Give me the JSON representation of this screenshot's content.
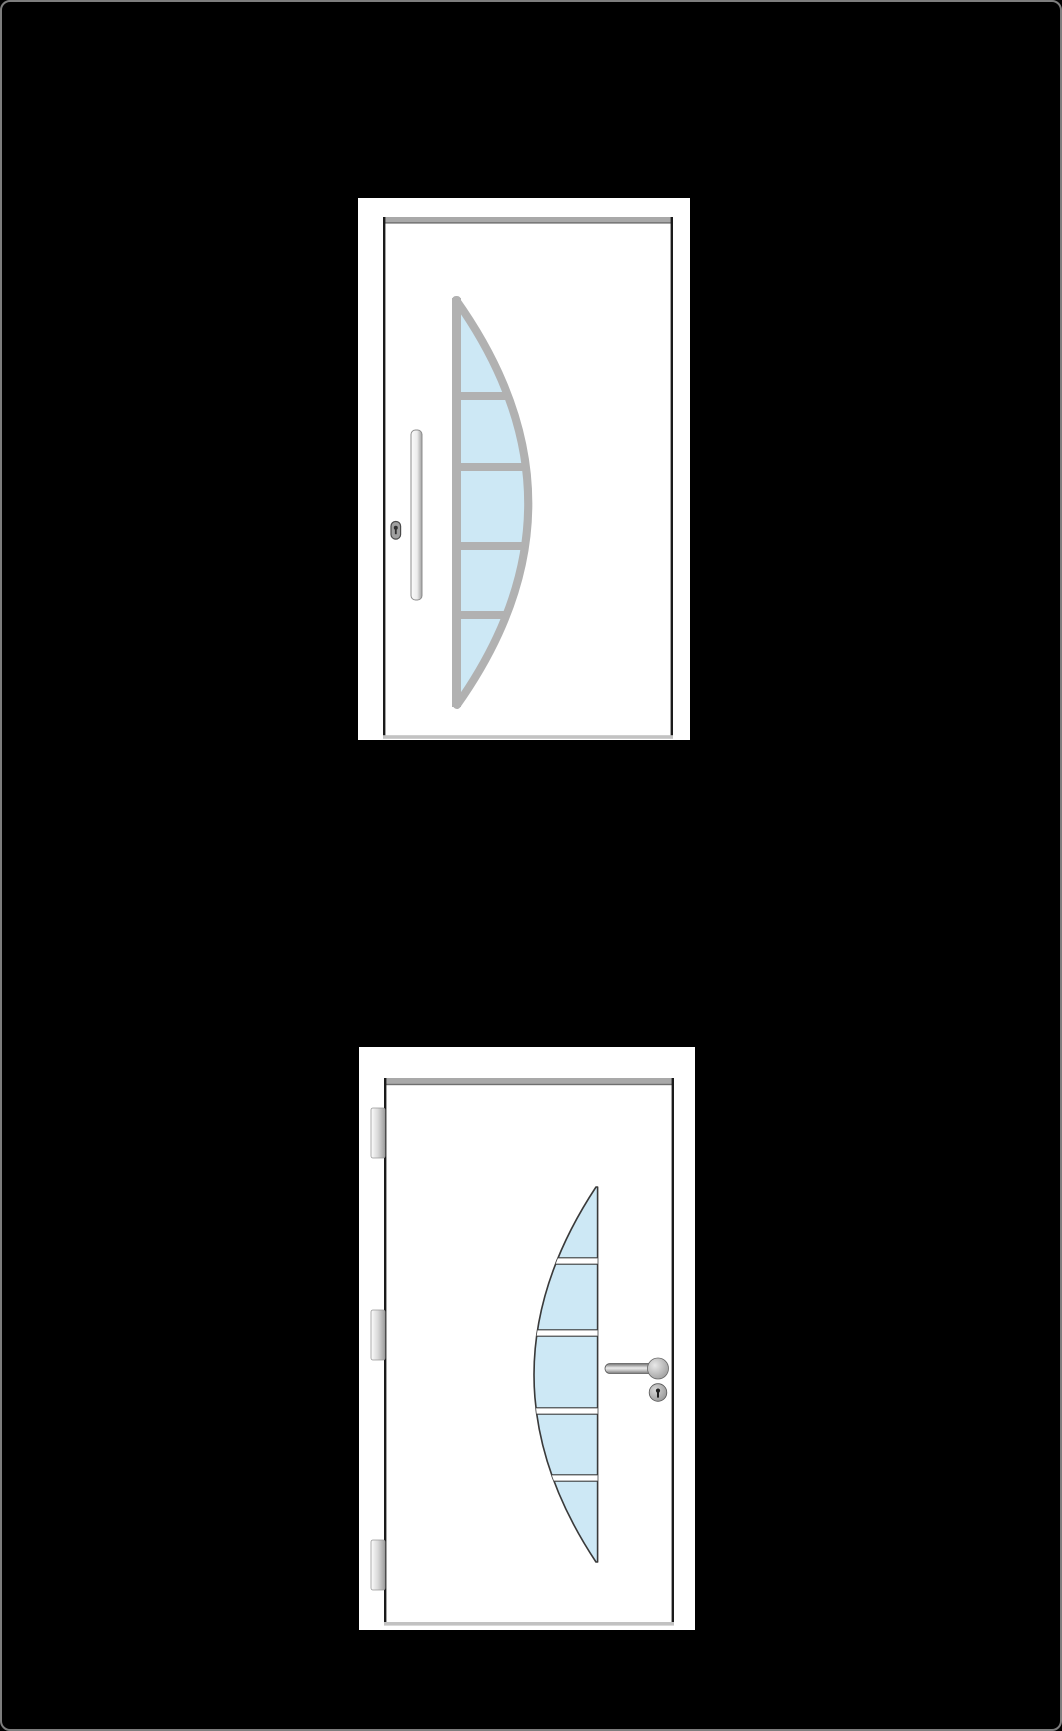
{
  "page": {
    "background": "#000000",
    "frame_border": "#7d7d7d"
  },
  "colors": {
    "page_bg": "#000000",
    "frame_border": "#7d7d7d",
    "door_white": "#ffffff",
    "glass_blue": "#cde8f5",
    "glass_frame_gray": "#b1b1b1",
    "pane_outline": "#3a3a3a",
    "leaf_outline": "#1b1b1b",
    "jamb_gray": "#a9a9a9",
    "threshold_gray": "#c2c2c2",
    "metal_gray": "#9a9a9a"
  },
  "gallery": {
    "items": [
      {
        "name": "white entry door, crescent glazing curving right",
        "glass_panes": 5,
        "glass_curve": "bulges-right",
        "hardware": [
          "vertical-bar-pull-handle",
          "keyhole-lock"
        ],
        "hinges_visible": false
      },
      {
        "name": "white entry door, crescent glazing curving left",
        "glass_panes": 5,
        "glass_curve": "bulges-left",
        "hardware": [
          "lever-handle",
          "lock-cylinder"
        ],
        "hinges_visible": true,
        "hinge_count": 3
      }
    ]
  }
}
